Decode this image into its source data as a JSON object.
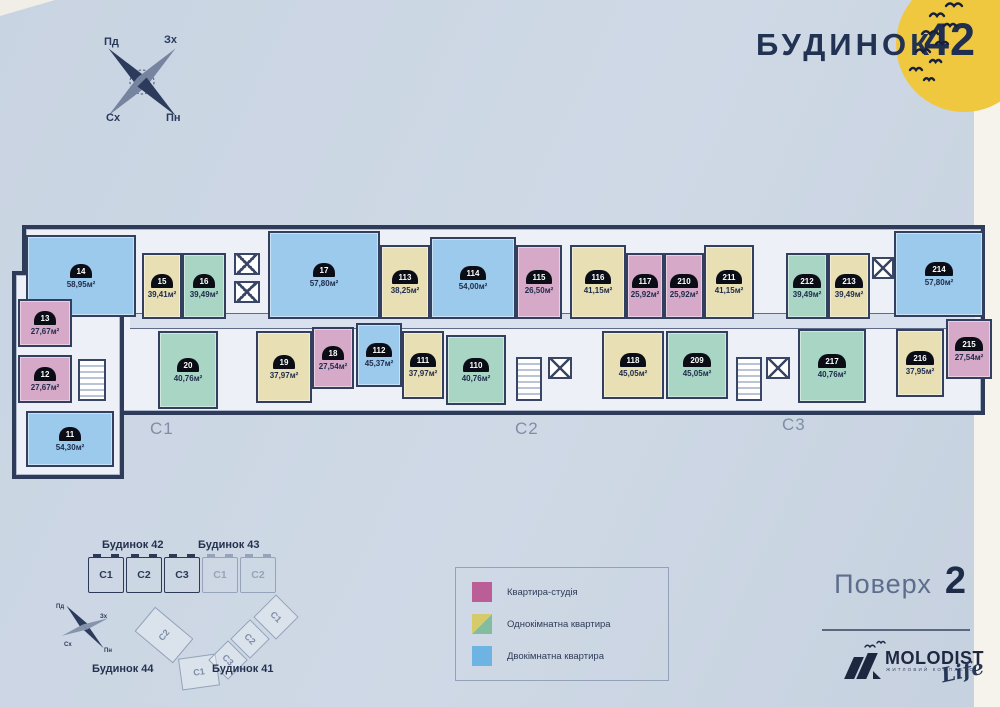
{
  "header": {
    "title": "БУДИНОК",
    "number": "42"
  },
  "compass": {
    "nw": "Пд",
    "ne": "Зх",
    "sw": "Сх",
    "se": "Пн"
  },
  "floor_plan": {
    "section_labels": [
      {
        "label": "C1",
        "x": 140,
        "y": 206
      },
      {
        "label": "C2",
        "x": 505,
        "y": 206
      },
      {
        "label": "C3",
        "x": 772,
        "y": 202
      }
    ],
    "apartments": [
      {
        "num": "14",
        "area": "58,95м²",
        "type": "two-room",
        "x": 16,
        "y": 22,
        "w": 110,
        "h": 82
      },
      {
        "num": "15",
        "area": "39,41м²",
        "type": "one-a",
        "x": 132,
        "y": 40,
        "w": 40,
        "h": 66
      },
      {
        "num": "16",
        "area": "39,49м²",
        "type": "one-b",
        "x": 172,
        "y": 40,
        "w": 44,
        "h": 66
      },
      {
        "num": "17",
        "area": "57,80м²",
        "type": "two-room",
        "x": 258,
        "y": 18,
        "w": 112,
        "h": 88
      },
      {
        "num": "113",
        "area": "38,25м²",
        "type": "one-a",
        "x": 370,
        "y": 32,
        "w": 50,
        "h": 74
      },
      {
        "num": "114",
        "area": "54,00м²",
        "type": "two-room",
        "x": 420,
        "y": 24,
        "w": 86,
        "h": 82
      },
      {
        "num": "115",
        "area": "26,50м²",
        "type": "studio",
        "x": 506,
        "y": 32,
        "w": 46,
        "h": 74
      },
      {
        "num": "116",
        "area": "41,15м²",
        "type": "one-a",
        "x": 560,
        "y": 32,
        "w": 56,
        "h": 74
      },
      {
        "num": "117",
        "area": "25,92м²",
        "type": "studio",
        "x": 616,
        "y": 40,
        "w": 38,
        "h": 66
      },
      {
        "num": "210",
        "area": "25,92м²",
        "type": "studio",
        "x": 654,
        "y": 40,
        "w": 40,
        "h": 66
      },
      {
        "num": "211",
        "area": "41,15м²",
        "type": "one-a",
        "x": 694,
        "y": 32,
        "w": 50,
        "h": 74
      },
      {
        "num": "212",
        "area": "39,49м²",
        "type": "one-b",
        "x": 776,
        "y": 40,
        "w": 42,
        "h": 66
      },
      {
        "num": "213",
        "area": "39,49м²",
        "type": "one-a",
        "x": 818,
        "y": 40,
        "w": 42,
        "h": 66
      },
      {
        "num": "214",
        "area": "57,80м²",
        "type": "two-room",
        "x": 884,
        "y": 18,
        "w": 90,
        "h": 86
      },
      {
        "num": "13",
        "area": "27,67м²",
        "type": "studio",
        "x": 8,
        "y": 86,
        "w": 54,
        "h": 48
      },
      {
        "num": "12",
        "area": "27,67м²",
        "type": "studio",
        "x": 8,
        "y": 142,
        "w": 54,
        "h": 48
      },
      {
        "num": "11",
        "area": "54,30м²",
        "type": "two-room",
        "x": 16,
        "y": 198,
        "w": 88,
        "h": 56
      },
      {
        "num": "20",
        "area": "40,76м²",
        "type": "one-b",
        "x": 148,
        "y": 118,
        "w": 60,
        "h": 78
      },
      {
        "num": "19",
        "area": "37,97м²",
        "type": "one-a",
        "x": 246,
        "y": 118,
        "w": 56,
        "h": 72
      },
      {
        "num": "18",
        "area": "27,54м²",
        "type": "studio",
        "x": 302,
        "y": 114,
        "w": 42,
        "h": 62
      },
      {
        "num": "112",
        "area": "45,37м²",
        "type": "two-room",
        "x": 346,
        "y": 110,
        "w": 46,
        "h": 64
      },
      {
        "num": "111",
        "area": "37,97м²",
        "type": "one-a",
        "x": 392,
        "y": 118,
        "w": 42,
        "h": 68
      },
      {
        "num": "110",
        "area": "40,76м²",
        "type": "one-b",
        "x": 436,
        "y": 122,
        "w": 60,
        "h": 70
      },
      {
        "num": "118",
        "area": "45,05м²",
        "type": "one-a",
        "x": 592,
        "y": 118,
        "w": 62,
        "h": 68
      },
      {
        "num": "209",
        "area": "45,05м²",
        "type": "one-b",
        "x": 656,
        "y": 118,
        "w": 62,
        "h": 68
      },
      {
        "num": "217",
        "area": "40,76м²",
        "type": "one-b",
        "x": 788,
        "y": 116,
        "w": 68,
        "h": 74
      },
      {
        "num": "216",
        "area": "37,95м²",
        "type": "one-a",
        "x": 886,
        "y": 116,
        "w": 48,
        "h": 68
      },
      {
        "num": "215",
        "area": "27,54м²",
        "type": "studio",
        "x": 936,
        "y": 106,
        "w": 46,
        "h": 60
      }
    ]
  },
  "legend": {
    "items": [
      {
        "label": "Квартира-студія",
        "swatch": "studio"
      },
      {
        "label": "Однокімнатна квартира",
        "swatch": "one-room"
      },
      {
        "label": "Двокімнатна квартира",
        "swatch": "two-room"
      }
    ]
  },
  "site_plan": {
    "building_42_label": "Будинок 42",
    "building_43_label": "Будинок 43",
    "building_44_label": "Будинок 44",
    "building_41_label": "Будинок 41",
    "row_blocks": [
      {
        "label": "C1",
        "active": true
      },
      {
        "label": "C2",
        "active": true
      },
      {
        "label": "C3",
        "active": true
      },
      {
        "label": "C1",
        "active": false
      },
      {
        "label": "C2",
        "active": false
      }
    ],
    "v_blocks": [
      {
        "label": "C2",
        "x": 30,
        "y": 12,
        "w": 32,
        "h": 50,
        "rot": -50
      },
      {
        "label": "C1",
        "x": 62,
        "y": 58,
        "w": 38,
        "h": 32,
        "rot": -8
      },
      {
        "label": "C3",
        "x": 96,
        "y": 48,
        "w": 28,
        "h": 28,
        "rot": 45
      },
      {
        "label": "C2",
        "x": 118,
        "y": 27,
        "w": 28,
        "h": 28,
        "rot": 45
      },
      {
        "label": "C1",
        "x": 142,
        "y": 3,
        "w": 32,
        "h": 32,
        "rot": 45
      }
    ],
    "compass": {
      "nw": "Пд",
      "ne": "Зх",
      "sw": "Сх",
      "se": "Пн"
    }
  },
  "footer": {
    "floor_label": "Поверх",
    "floor_number": "2",
    "brand": "MOLODIST",
    "brand_tagline": "ЖИТЛОВИЙ КОМПЛЕКС",
    "brand_script": "Life"
  },
  "colors": {
    "background": "#ccd6e3",
    "sun": "#efc83f",
    "navy_text": "#22304e",
    "legend_studio": "#bb5e97",
    "legend_one_room_yellow": "#d6cb6b",
    "legend_one_room_green": "#83bda0",
    "legend_two_room": "#6db4e2",
    "apt_studio": "#d7a9c8",
    "apt_one_a": "#e9dfb4",
    "apt_one_b": "#a8d5c4",
    "apt_two": "#9ccaec"
  }
}
